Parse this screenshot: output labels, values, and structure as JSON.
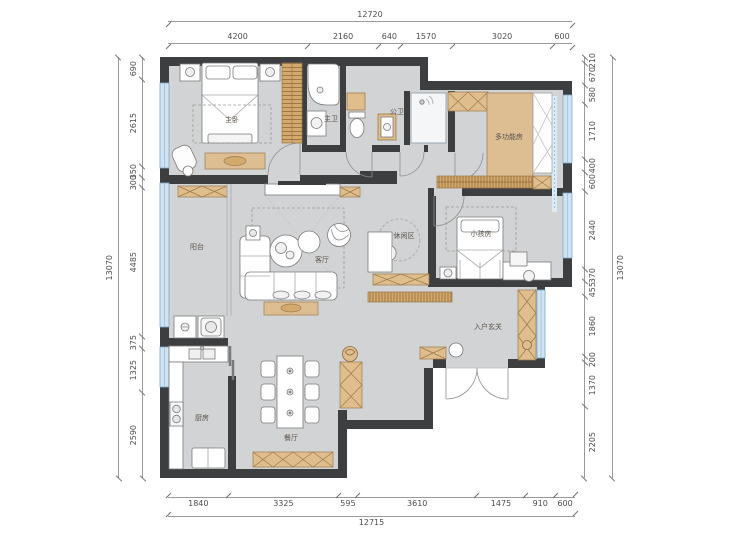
{
  "dims": {
    "top": {
      "total": "12720",
      "segments": [
        "4200",
        "2160",
        "640",
        "1570",
        "3020",
        "600"
      ]
    },
    "bottom": {
      "total": "12715",
      "segments": [
        "1840",
        "3325",
        "595",
        "3610",
        "1475",
        "910",
        "600"
      ]
    },
    "left": {
      "total": "13070",
      "segments": [
        "690",
        "2615",
        "350",
        "300",
        "4485",
        "375",
        "1325",
        "2590"
      ]
    },
    "right": {
      "total": "13070",
      "segments": [
        "210",
        "670",
        "580",
        "1710",
        "400",
        "600",
        "2440",
        "370",
        "455",
        "1860",
        "200",
        "1370",
        "2205"
      ]
    }
  },
  "rooms": [
    {
      "id": "master-bedroom",
      "label": "主卧"
    },
    {
      "id": "master-bathroom",
      "label": "主卫"
    },
    {
      "id": "public-bathroom",
      "label": "公卫"
    },
    {
      "id": "multifunction-room",
      "label": "多功能房"
    },
    {
      "id": "kids-room",
      "label": "小孩房"
    },
    {
      "id": "leisure-area",
      "label": "休闲区"
    },
    {
      "id": "living-room",
      "label": "客厅"
    },
    {
      "id": "balcony",
      "label": "阳台"
    },
    {
      "id": "entry-foyer",
      "label": "入户玄关"
    },
    {
      "id": "kitchen",
      "label": "厨房"
    },
    {
      "id": "dining-room",
      "label": "餐厅"
    }
  ],
  "colors": {
    "wall": "#3d3e40",
    "floor": "#d2d3d4",
    "cabinet": "#e0bd8c",
    "cabinet_dark": "#d3a96e",
    "window_fill": "#cfe3f2",
    "window_frame": "#7fa8c9"
  }
}
